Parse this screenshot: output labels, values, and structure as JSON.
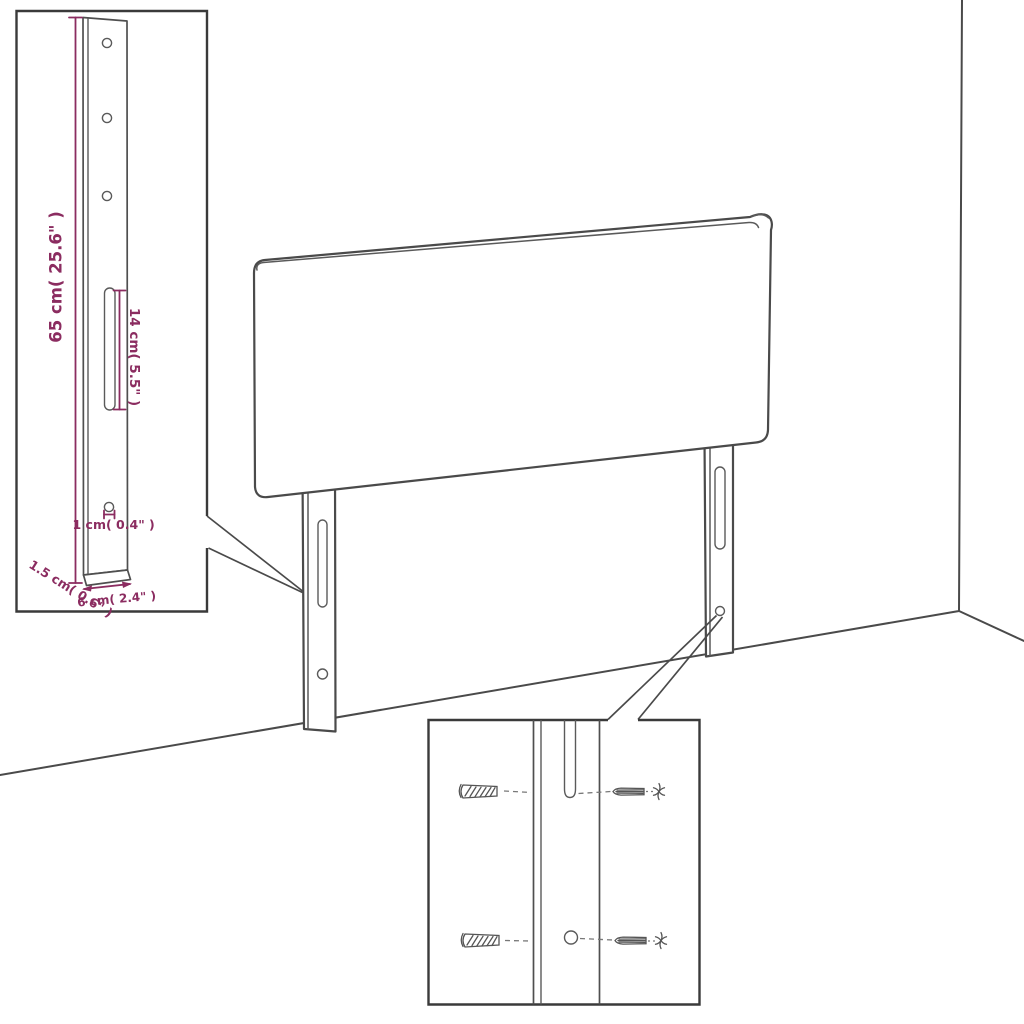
{
  "diagram": {
    "kind": "headboard-assembly-dimension-diagram",
    "colors": {
      "dimension_accent": "#8b2c60",
      "drawing_line": "#4a4a4a",
      "inset_border": "#3a3a3a",
      "leader_line": "#787878",
      "background": "#ffffff"
    },
    "bracket_detail": {
      "height_label": "65 cm( 25.6\" )",
      "slot_label": "14 cm( 5.5\" )",
      "hole_label": "1 cm( 0.4\" )",
      "thickness_label": "1.5 cm( 0.6\" )",
      "width_label": "6 cm( 2.4\" )"
    }
  }
}
